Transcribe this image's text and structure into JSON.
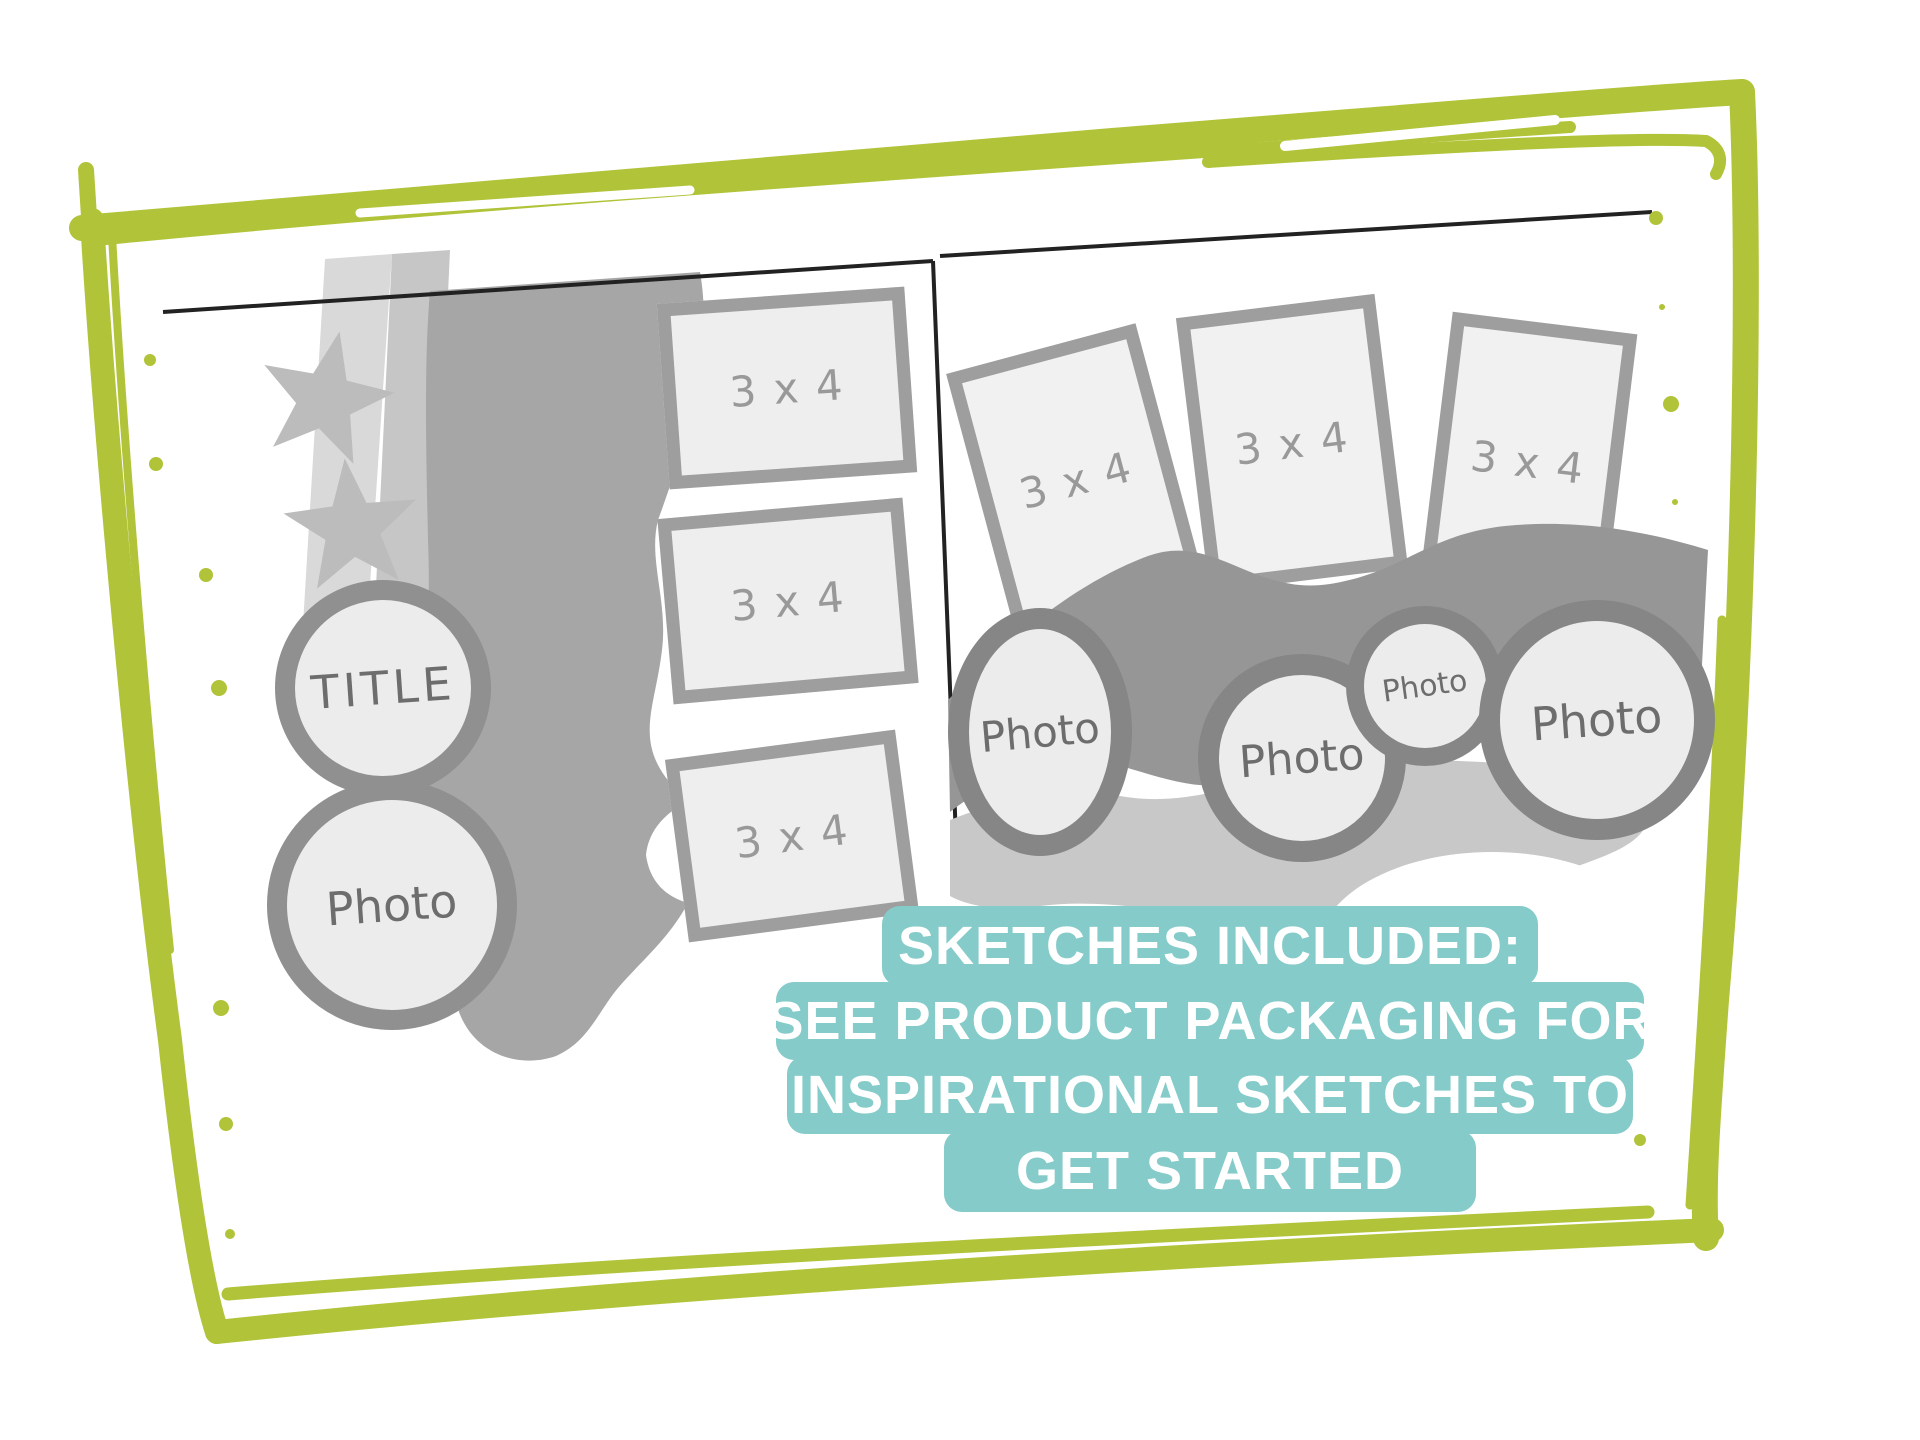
{
  "colors": {
    "frame_green": "#b1c338",
    "dot_green": "#b1c338",
    "spread_line": "#222222",
    "sketch_light_fill": "#ececec",
    "sketch_border_gray": "#9e9e9e",
    "left_band_gray": "#a6a6a6",
    "right_wave_gray": "#969696",
    "right_light_band_gray": "#c8c8c8",
    "star_gray": "#bcbcbc",
    "label_gray": "#6d6d6d",
    "notice_teal": "#84cbc9",
    "notice_text": "#ffffff"
  },
  "left_page": {
    "title_circle": {
      "label": "TITLE"
    },
    "photo_circle": {
      "label": "Photo"
    },
    "rects": [
      {
        "label": "3 x 4"
      },
      {
        "label": "3 x 4"
      },
      {
        "label": "3 x 4"
      }
    ]
  },
  "right_page": {
    "rects": [
      {
        "label": "3 x 4"
      },
      {
        "label": "3 x 4"
      },
      {
        "label": "3 x 4"
      }
    ],
    "photo_circles": [
      {
        "label": "Photo"
      },
      {
        "label": "Photo"
      },
      {
        "label": "Photo"
      },
      {
        "label": "Photo"
      }
    ]
  },
  "notice": {
    "bg": "#84cbc9",
    "text_color": "#ffffff",
    "lines": [
      "SKETCHES INCLUDED:",
      "SEE PRODUCT PACKAGING FOR",
      "INSPIRATIONAL SKETCHES TO",
      "GET STARTED"
    ]
  }
}
